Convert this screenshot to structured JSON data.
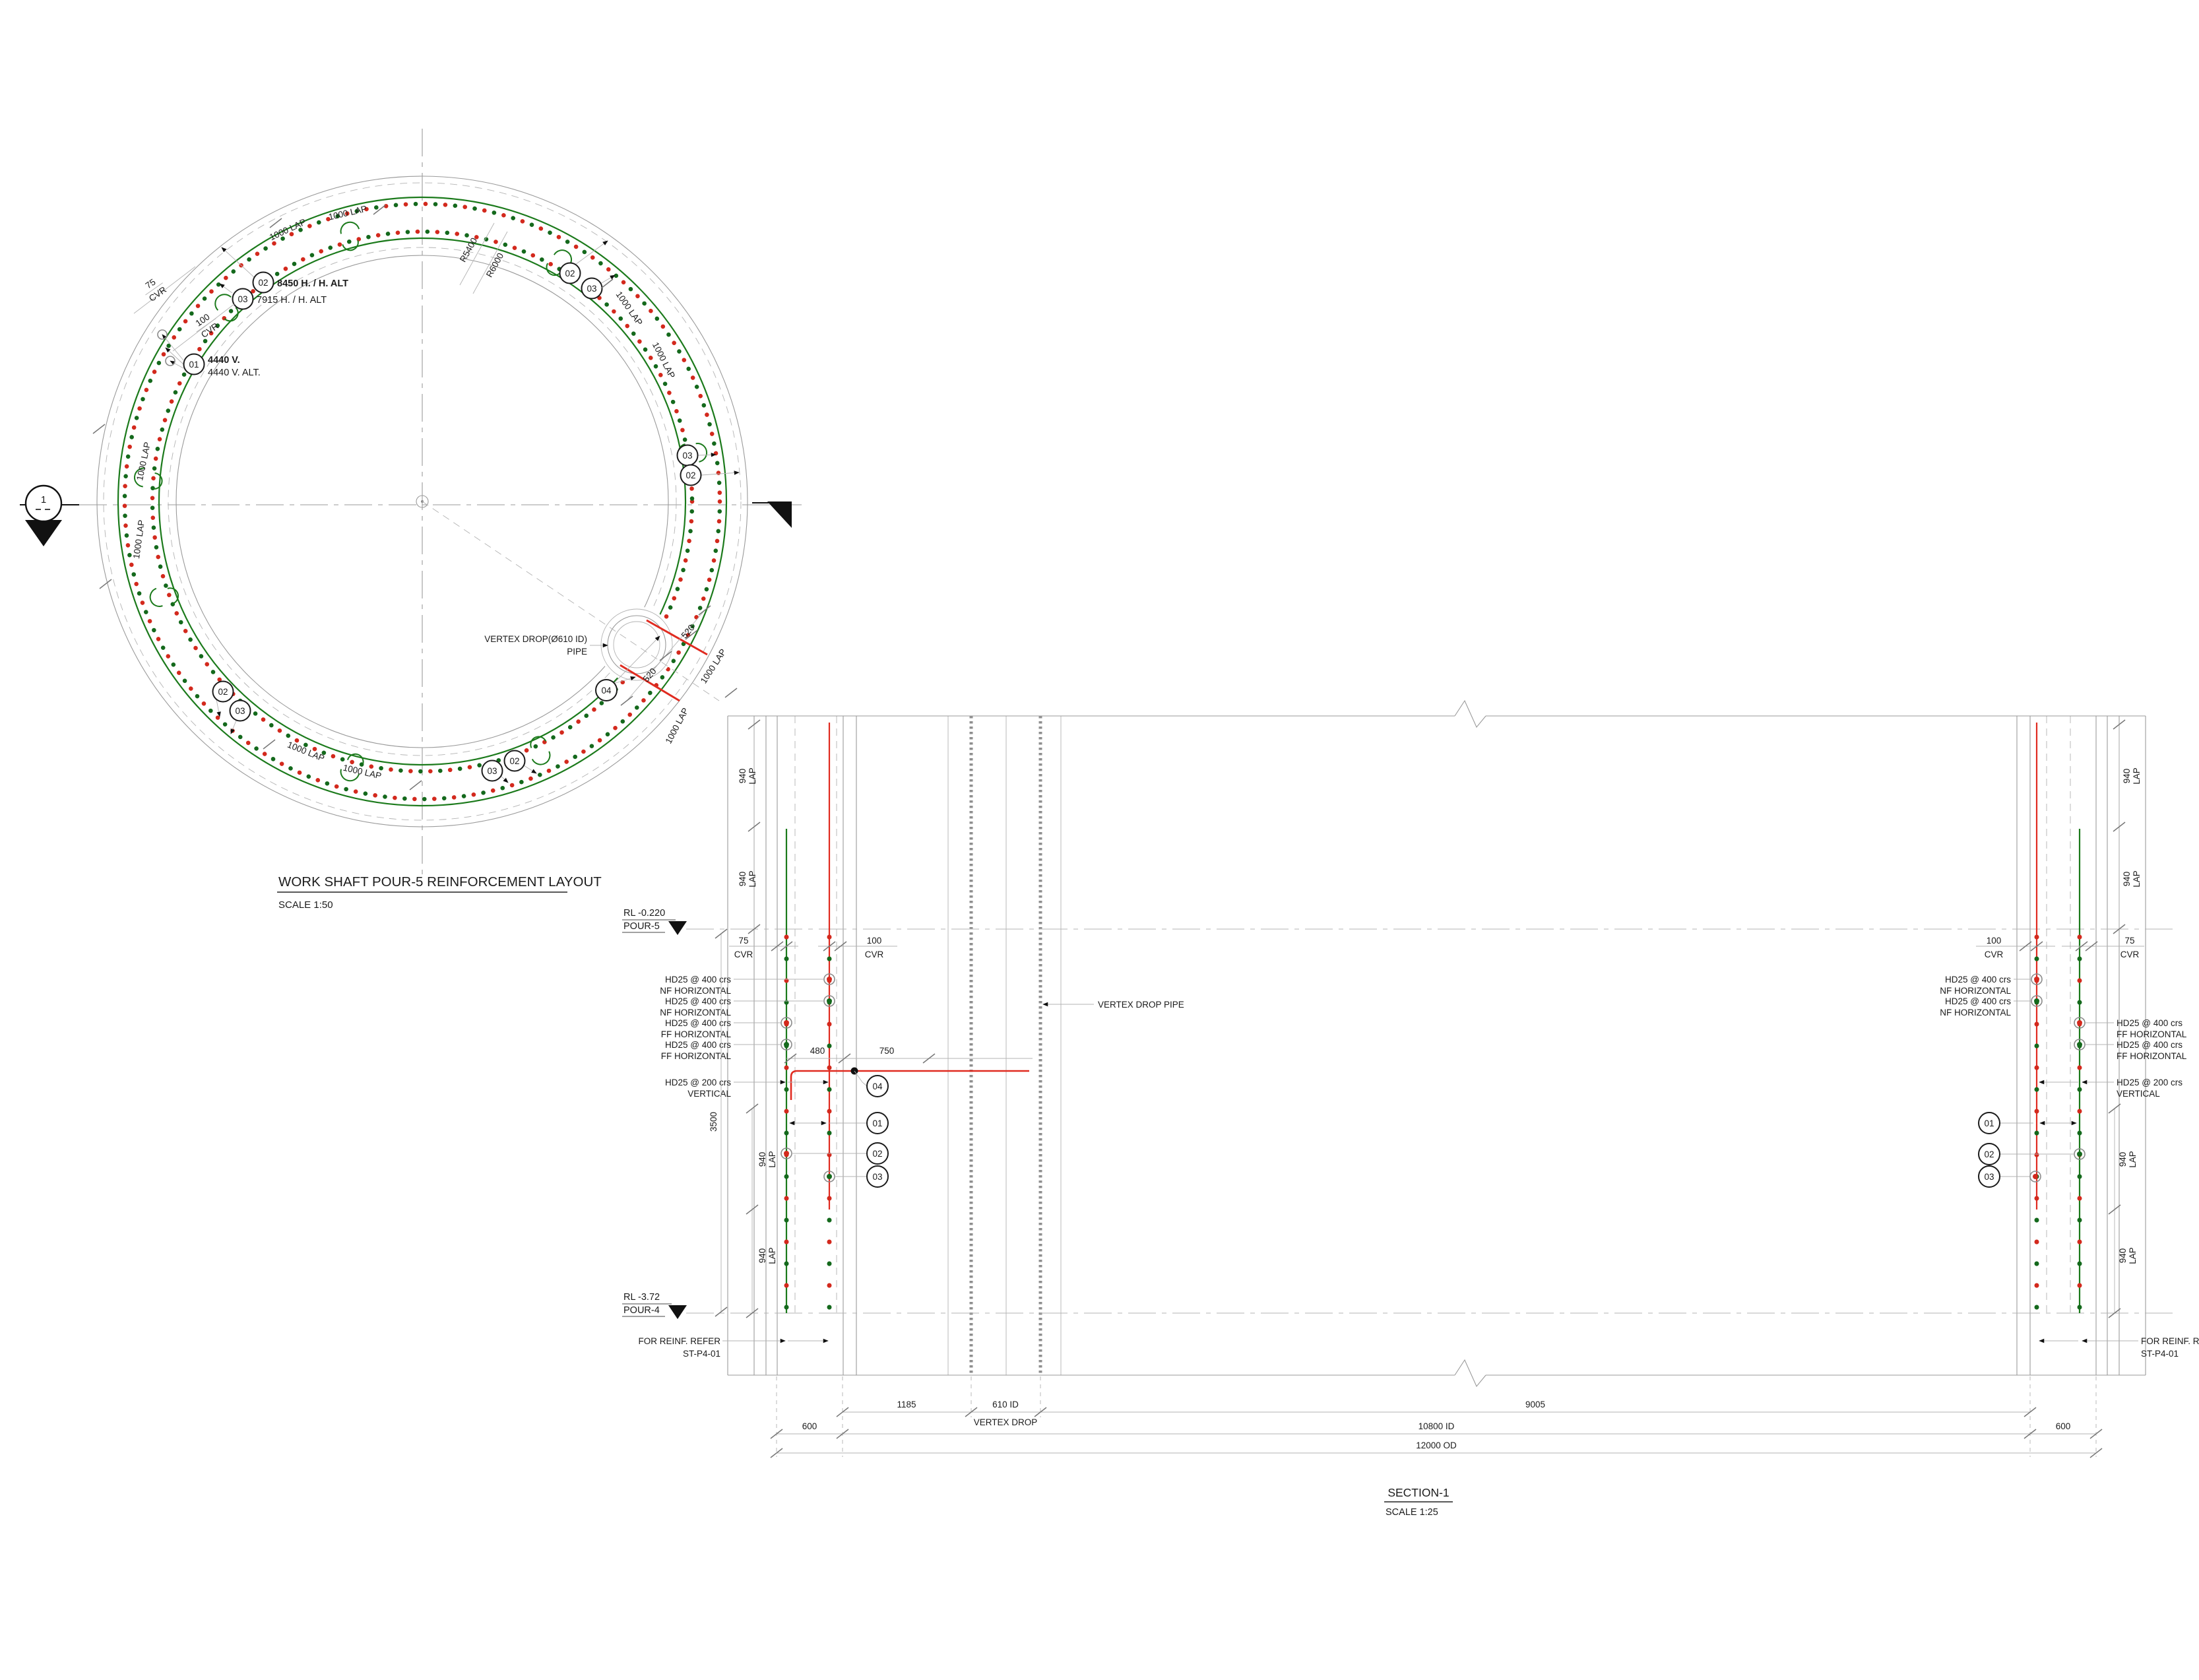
{
  "plan": {
    "title": "WORK SHAFT  POUR-5 REINFORCEMENT LAYOUT",
    "scale": "SCALE 1:50",
    "section_marker": "1",
    "radius_inner_label": "R5400",
    "radius_outer_label": "R6000",
    "lap_label": "1000 LAP",
    "cover_outer": {
      "value": "75",
      "unit": "CVR"
    },
    "cover_inner": {
      "value": "100",
      "unit": "CVR"
    },
    "callout_01": {
      "id": "01",
      "line1": "4440 V.",
      "line2": "4440 V. ALT."
    },
    "callout_02": {
      "id": "02",
      "text": "8450 H. / H. ALT"
    },
    "callout_03": {
      "id": "03",
      "text": "7915 H. / H. ALT"
    },
    "callout_04": {
      "id": "04"
    },
    "vertex_pipe": {
      "line1": "VERTEX DROP(Ø610 ID)",
      "line2": "PIPE"
    },
    "dim_520": "520"
  },
  "section": {
    "title": "SECTION-1",
    "scale": "SCALE 1:25",
    "level_top": {
      "rl": "RL -0.220",
      "pour": "POUR-5"
    },
    "level_bottom": {
      "rl": "RL -3.72",
      "pour": "POUR-4"
    },
    "cvr_75": {
      "value": "75",
      "unit": "CVR"
    },
    "cvr_100": {
      "value": "100",
      "unit": "CVR"
    },
    "bar_nf": {
      "l1": "HD25 @ 400 crs",
      "l2": "NF HORIZONTAL"
    },
    "bar_ff": {
      "l1": "HD25 @ 400 crs",
      "l2": "FF HORIZONTAL"
    },
    "bar_vertical": {
      "l1": "HD25 @ 200 crs",
      "l2": "VERTICAL"
    },
    "vertex_pipe_label": "VERTEX DROP PIPE",
    "refer_note": {
      "l1": "FOR REINF. REFER",
      "l2": "ST-P4-01"
    },
    "lap_940": {
      "value": "940",
      "unit": "LAP"
    },
    "dim_3500": "3500",
    "dim_480": "480",
    "dim_750": "750",
    "dim_1185": "1185",
    "dim_610": {
      "l1": "610 ID",
      "l2": "VERTEX DROP"
    },
    "dim_9005": "9005",
    "dim_600": "600",
    "dim_10800": "10800 ID",
    "dim_12000": "12000 OD",
    "c01": "01",
    "c02": "02",
    "c03": "03",
    "c04": "04"
  },
  "colors": {
    "rebar_green": "#1b7a1b",
    "rebar_red": "#e02b20",
    "line_grey": "#9a9a9a",
    "text": "#1c1c1c",
    "background": "#ffffff"
  }
}
